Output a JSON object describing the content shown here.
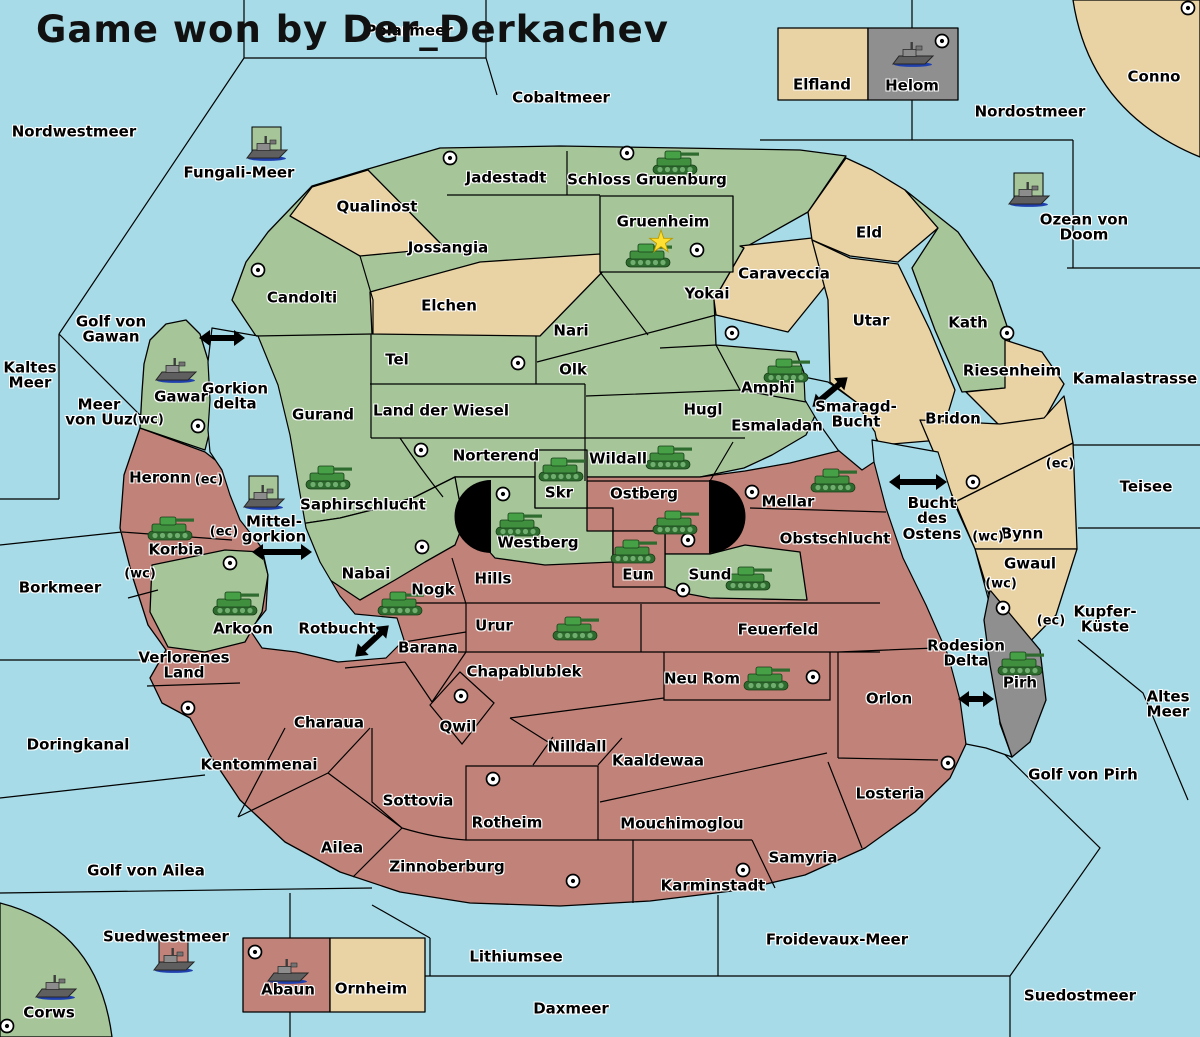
{
  "map": {
    "title": "Game won by Der_Derkachev",
    "colors": {
      "sea": "#A6DBE7",
      "green_land": "#A6C69A",
      "tan_land": "#E9D3A4",
      "red_land": "#C18379",
      "gray_land": "#8F8F8F",
      "border": "#000000",
      "label_halo": "#FFFFFF",
      "army": "#3F8F3F",
      "fleet": "#6A6A6A",
      "victory_star": "#FFE032"
    },
    "sea_zones": [
      {
        "name": "Nordwestmeer",
        "x": 74,
        "y": 132
      },
      {
        "name": "Polarmeer",
        "x": 409,
        "y": 31
      },
      {
        "name": "Cobaltmeer",
        "x": 561,
        "y": 98
      },
      {
        "name": "Fungali-Meer",
        "x": 239,
        "y": 173
      },
      {
        "name": "Nordostmeer",
        "x": 1030,
        "y": 112
      },
      {
        "name": "Ozean von Doom",
        "x": 1084,
        "y": 228
      },
      {
        "name": "Kamalastrasse",
        "x": 1135,
        "y": 379
      },
      {
        "name": "Golf von\nGawan",
        "x": 111,
        "y": 330
      },
      {
        "name": "Kaltes\nMeer",
        "x": 30,
        "y": 376
      },
      {
        "name": "Meer\nvon Uuz",
        "x": 99,
        "y": 413
      },
      {
        "name": "Gorkion\ndelta",
        "x": 235,
        "y": 397
      },
      {
        "name": "Mittel-\ngorkion",
        "x": 274,
        "y": 530
      },
      {
        "name": "Borkmeer",
        "x": 60,
        "y": 588
      },
      {
        "name": "Doringkanal",
        "x": 78,
        "y": 745
      },
      {
        "name": "Rotbucht",
        "x": 337,
        "y": 629
      },
      {
        "name": "Smaragd-\nBucht",
        "x": 856,
        "y": 415
      },
      {
        "name": "Bucht\ndes\nOstens",
        "x": 932,
        "y": 519
      },
      {
        "name": "Teisee",
        "x": 1146,
        "y": 487
      },
      {
        "name": "Kupfer-\nKüste",
        "x": 1105,
        "y": 620
      },
      {
        "name": "Rodesion\nDelta",
        "x": 966,
        "y": 654
      },
      {
        "name": "Altes\nMeer",
        "x": 1168,
        "y": 705
      },
      {
        "name": "Golf von Pirh",
        "x": 1083,
        "y": 775
      },
      {
        "name": "Golf von Ailea",
        "x": 146,
        "y": 871
      },
      {
        "name": "Suedwestmeer",
        "x": 166,
        "y": 937
      },
      {
        "name": "Lithiumsee",
        "x": 516,
        "y": 957
      },
      {
        "name": "Froidevaux-Meer",
        "x": 837,
        "y": 940
      },
      {
        "name": "Daxmeer",
        "x": 571,
        "y": 1009
      },
      {
        "name": "Suedostmeer",
        "x": 1080,
        "y": 996
      }
    ],
    "territories": [
      {
        "name": "Jadestadt",
        "x": 506,
        "y": 178
      },
      {
        "name": "Schloss Gruenburg",
        "x": 647,
        "y": 180
      },
      {
        "name": "Qualinost",
        "x": 377,
        "y": 207
      },
      {
        "name": "Gruenheim",
        "x": 663,
        "y": 222
      },
      {
        "name": "Jossangia",
        "x": 448,
        "y": 248
      },
      {
        "name": "Elfland",
        "x": 822,
        "y": 85
      },
      {
        "name": "Helom",
        "x": 912,
        "y": 86
      },
      {
        "name": "Conno",
        "x": 1154,
        "y": 77
      },
      {
        "name": "Eld",
        "x": 869,
        "y": 233
      },
      {
        "name": "Caraveccia",
        "x": 784,
        "y": 274
      },
      {
        "name": "Yokai",
        "x": 707,
        "y": 294
      },
      {
        "name": "Candolti",
        "x": 302,
        "y": 298
      },
      {
        "name": "Elchen",
        "x": 449,
        "y": 306
      },
      {
        "name": "Utar",
        "x": 871,
        "y": 321
      },
      {
        "name": "Kath",
        "x": 968,
        "y": 323
      },
      {
        "name": "Nari",
        "x": 571,
        "y": 331
      },
      {
        "name": "Tel",
        "x": 397,
        "y": 360
      },
      {
        "name": "Olk",
        "x": 573,
        "y": 370
      },
      {
        "name": "Riesenheim",
        "x": 1012,
        "y": 371
      },
      {
        "name": "Amphi",
        "x": 768,
        "y": 388
      },
      {
        "name": "Gawar",
        "x": 181,
        "y": 397
      },
      {
        "name": "Land der Wiesel",
        "x": 441,
        "y": 411
      },
      {
        "name": "Hugl",
        "x": 703,
        "y": 410
      },
      {
        "name": "Gurand",
        "x": 323,
        "y": 415
      },
      {
        "name": "Bridon",
        "x": 953,
        "y": 419
      },
      {
        "name": "Esmaladan",
        "x": 777,
        "y": 426
      },
      {
        "name": "Norterend",
        "x": 496,
        "y": 456
      },
      {
        "name": "Wildall",
        "x": 618,
        "y": 459
      },
      {
        "name": "Heronn",
        "x": 160,
        "y": 478
      },
      {
        "name": "Skr",
        "x": 559,
        "y": 493
      },
      {
        "name": "Ostberg",
        "x": 644,
        "y": 494
      },
      {
        "name": "Mellar",
        "x": 788,
        "y": 502
      },
      {
        "name": "Saphirschlucht",
        "x": 363,
        "y": 505
      },
      {
        "name": "Bynn",
        "x": 1022,
        "y": 534
      },
      {
        "name": "Obstschlucht",
        "x": 835,
        "y": 539
      },
      {
        "name": "Westberg",
        "x": 538,
        "y": 543
      },
      {
        "name": "Korbia",
        "x": 176,
        "y": 550
      },
      {
        "name": "Gwaul",
        "x": 1030,
        "y": 564
      },
      {
        "name": "Nabai",
        "x": 366,
        "y": 574
      },
      {
        "name": "Eun",
        "x": 638,
        "y": 575
      },
      {
        "name": "Sund",
        "x": 710,
        "y": 575
      },
      {
        "name": "Hills",
        "x": 493,
        "y": 579
      },
      {
        "name": "Nogk",
        "x": 433,
        "y": 590
      },
      {
        "name": "Urur",
        "x": 494,
        "y": 626
      },
      {
        "name": "Arkoon",
        "x": 243,
        "y": 629
      },
      {
        "name": "Feuerfeld",
        "x": 778,
        "y": 630
      },
      {
        "name": "Barana",
        "x": 428,
        "y": 648
      },
      {
        "name": "Verlorenes\nLand",
        "x": 184,
        "y": 666
      },
      {
        "name": "Chapablublek",
        "x": 524,
        "y": 672
      },
      {
        "name": "Neu Rom",
        "x": 702,
        "y": 679
      },
      {
        "name": "Pirh",
        "x": 1020,
        "y": 683
      },
      {
        "name": "Orlon",
        "x": 889,
        "y": 699
      },
      {
        "name": "Charaua",
        "x": 329,
        "y": 723
      },
      {
        "name": "Qwil",
        "x": 458,
        "y": 727
      },
      {
        "name": "Nilldall",
        "x": 577,
        "y": 747
      },
      {
        "name": "Kaaldewaa",
        "x": 658,
        "y": 761
      },
      {
        "name": "Kentommenai",
        "x": 259,
        "y": 765
      },
      {
        "name": "Losteria",
        "x": 890,
        "y": 794
      },
      {
        "name": "Sottovia",
        "x": 418,
        "y": 801
      },
      {
        "name": "Rotheim",
        "x": 507,
        "y": 823
      },
      {
        "name": "Mouchimoglou",
        "x": 682,
        "y": 824
      },
      {
        "name": "Ailea",
        "x": 342,
        "y": 848
      },
      {
        "name": "Samyria",
        "x": 803,
        "y": 858
      },
      {
        "name": "Zinnoberburg",
        "x": 447,
        "y": 867
      },
      {
        "name": "Karminstadt",
        "x": 713,
        "y": 886
      },
      {
        "name": "Abaun",
        "x": 288,
        "y": 990
      },
      {
        "name": "Ornheim",
        "x": 371,
        "y": 989
      },
      {
        "name": "Corws",
        "x": 49,
        "y": 1013
      }
    ],
    "coast_markers": [
      {
        "text": "(wc)",
        "x": 148,
        "y": 420
      },
      {
        "text": "(ec)",
        "x": 209,
        "y": 480
      },
      {
        "text": "(ec)",
        "x": 224,
        "y": 532
      },
      {
        "text": "(wc)",
        "x": 140,
        "y": 574
      },
      {
        "text": "(ec)",
        "x": 1060,
        "y": 464
      },
      {
        "text": "(wc)",
        "x": 988,
        "y": 537
      },
      {
        "text": "(wc)",
        "x": 1001,
        "y": 584
      },
      {
        "text": "(ec)",
        "x": 1051,
        "y": 621
      }
    ],
    "supply_centers": [
      [
        450,
        158
      ],
      [
        627,
        153
      ],
      [
        697,
        250
      ],
      [
        942,
        41
      ],
      [
        1188,
        8
      ],
      [
        258,
        270
      ],
      [
        732,
        333
      ],
      [
        1007,
        333
      ],
      [
        518,
        363
      ],
      [
        198,
        426
      ],
      [
        421,
        450
      ],
      [
        503,
        494
      ],
      [
        688,
        540
      ],
      [
        752,
        492
      ],
      [
        683,
        590
      ],
      [
        973,
        482
      ],
      [
        230,
        563
      ],
      [
        422,
        547
      ],
      [
        188,
        708
      ],
      [
        461,
        696
      ],
      [
        813,
        677
      ],
      [
        948,
        763
      ],
      [
        1003,
        608
      ],
      [
        493,
        779
      ],
      [
        573,
        881
      ],
      [
        743,
        870
      ],
      [
        255,
        952
      ],
      [
        7,
        1026
      ]
    ],
    "units": [
      {
        "type": "army",
        "x": 675,
        "y": 163
      },
      {
        "type": "army",
        "x": 648,
        "y": 256
      },
      {
        "type": "army",
        "x": 786,
        "y": 371
      },
      {
        "type": "army",
        "x": 668,
        "y": 458
      },
      {
        "type": "army",
        "x": 561,
        "y": 470
      },
      {
        "type": "army",
        "x": 518,
        "y": 525
      },
      {
        "type": "army",
        "x": 675,
        "y": 523
      },
      {
        "type": "army",
        "x": 633,
        "y": 552
      },
      {
        "type": "army",
        "x": 748,
        "y": 579
      },
      {
        "type": "army",
        "x": 833,
        "y": 481
      },
      {
        "type": "army",
        "x": 328,
        "y": 478
      },
      {
        "type": "army",
        "x": 170,
        "y": 529
      },
      {
        "type": "army",
        "x": 235,
        "y": 604
      },
      {
        "type": "army",
        "x": 400,
        "y": 604
      },
      {
        "type": "army",
        "x": 575,
        "y": 629
      },
      {
        "type": "army",
        "x": 766,
        "y": 679
      },
      {
        "type": "army",
        "x": 1020,
        "y": 664
      },
      {
        "type": "fleet",
        "x": 912,
        "y": 57,
        "flag": null
      },
      {
        "type": "fleet",
        "x": 175,
        "y": 373,
        "flag": null
      },
      {
        "type": "fleet",
        "x": 55,
        "y": 990,
        "flag": null
      },
      {
        "type": "fleet",
        "x": 287,
        "y": 974,
        "flag": null
      },
      {
        "type": "fleet",
        "x": 266,
        "y": 151,
        "flag": "green"
      },
      {
        "type": "fleet",
        "x": 1028,
        "y": 197,
        "flag": "green"
      },
      {
        "type": "fleet",
        "x": 263,
        "y": 500,
        "flag": "green"
      },
      {
        "type": "fleet",
        "x": 173,
        "y": 963,
        "flag": "red"
      }
    ],
    "crossing_arrows": [
      {
        "x": 222,
        "y": 338,
        "len": 46,
        "angle": 0
      },
      {
        "x": 830,
        "y": 392,
        "len": 46,
        "angle": -40
      },
      {
        "x": 282,
        "y": 552,
        "len": 60,
        "angle": 0
      },
      {
        "x": 372,
        "y": 641,
        "len": 46,
        "angle": -43
      },
      {
        "x": 918,
        "y": 482,
        "len": 58,
        "angle": 0
      },
      {
        "x": 976,
        "y": 699,
        "len": 36,
        "angle": 0
      }
    ],
    "victory_star": {
      "x": 661,
      "y": 242
    }
  }
}
